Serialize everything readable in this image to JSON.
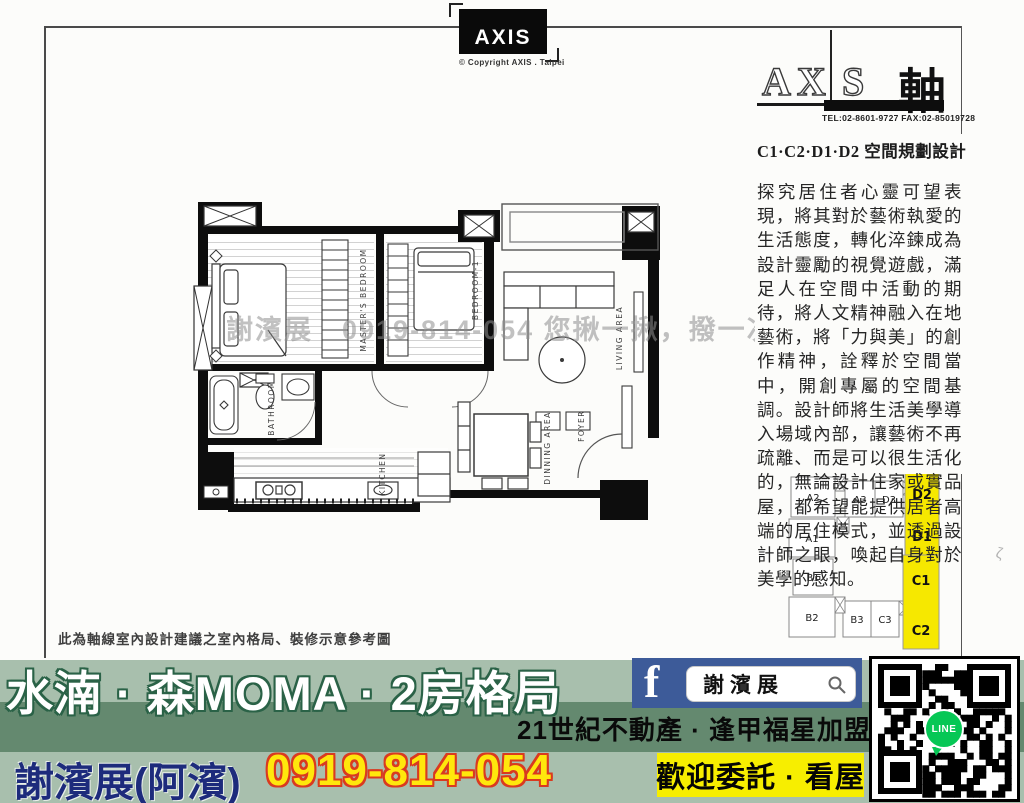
{
  "header": {
    "axis_logo": {
      "text": "AXIS",
      "copyright": "© Copyright AXIS . Taipei"
    },
    "brand": {
      "left": "AX",
      "right": "S",
      "cjk": "軸",
      "contact": "TEL:02-8601-9727  FAX:02-85019728"
    }
  },
  "design": {
    "heading": "C1·C2·D1·D2 空間規劃設計",
    "body": "探究居住者心靈可望表現，將其對於藝術執愛的生活態度，轉化淬鍊成為設計靈勵的視覺遊戲，滿足人在空間中活動的期待，將人文精神融入在地藝術，將「力與美」的創作精神，詮釋於空間當中，開創專屬的空間基調。設計師將生活美學導入場域內部，讓藝術不再疏離、而是可以很生活化的，無論設計住家或實品屋，都希望能提供居者高端的居住模式，並透過設計師之眼，喚起自身對於美學的感知。"
  },
  "plan": {
    "watermark": "謝濱展　0919-814-054 您揪一揪，撥一次，您我認識",
    "caption": "此為軸線室內設計建議之室內格局、裝修示意參考圖",
    "labels": {
      "master": "MASTER'S BEDROOM",
      "bedroom1": "BEDROOM-1",
      "living": "LIVING AREA",
      "bathroom": "BATHROOM",
      "kitchen": "KITCHEN",
      "dining": "DINNING AREA",
      "foyer": "FOYER"
    }
  },
  "keyplans": {
    "highlight_color": "#f6e800",
    "upper": {
      "units": [
        "A2",
        "A3",
        "D3",
        "A1"
      ],
      "highlighted": [
        "D2",
        "D1"
      ]
    },
    "lower": {
      "units": [
        "B1",
        "B2",
        "B3",
        "C3"
      ],
      "highlighted": [
        "C1",
        "C2"
      ]
    }
  },
  "footer": {
    "project_title": "水湳 · 森MOMA · 2房格局",
    "agency": "21世紀不動產 · 逢甲福星加盟店",
    "agent_name": "謝濱展(阿濱)",
    "phone": "0919-814-054",
    "cta": "歡迎委託 · 看屋",
    "facebook_search": "謝濱展",
    "line_label": "LINE",
    "colors": {
      "band_light": "#a8bfad",
      "band_dark": "#64896f",
      "fb_blue": "#3d5b99",
      "cta_yellow": "#f7ee00",
      "phone_yellow": "#ffe70c",
      "phone_outline": "#d93a20",
      "name_navy": "#1d2b7c",
      "title_outline": "#2a6247"
    }
  }
}
